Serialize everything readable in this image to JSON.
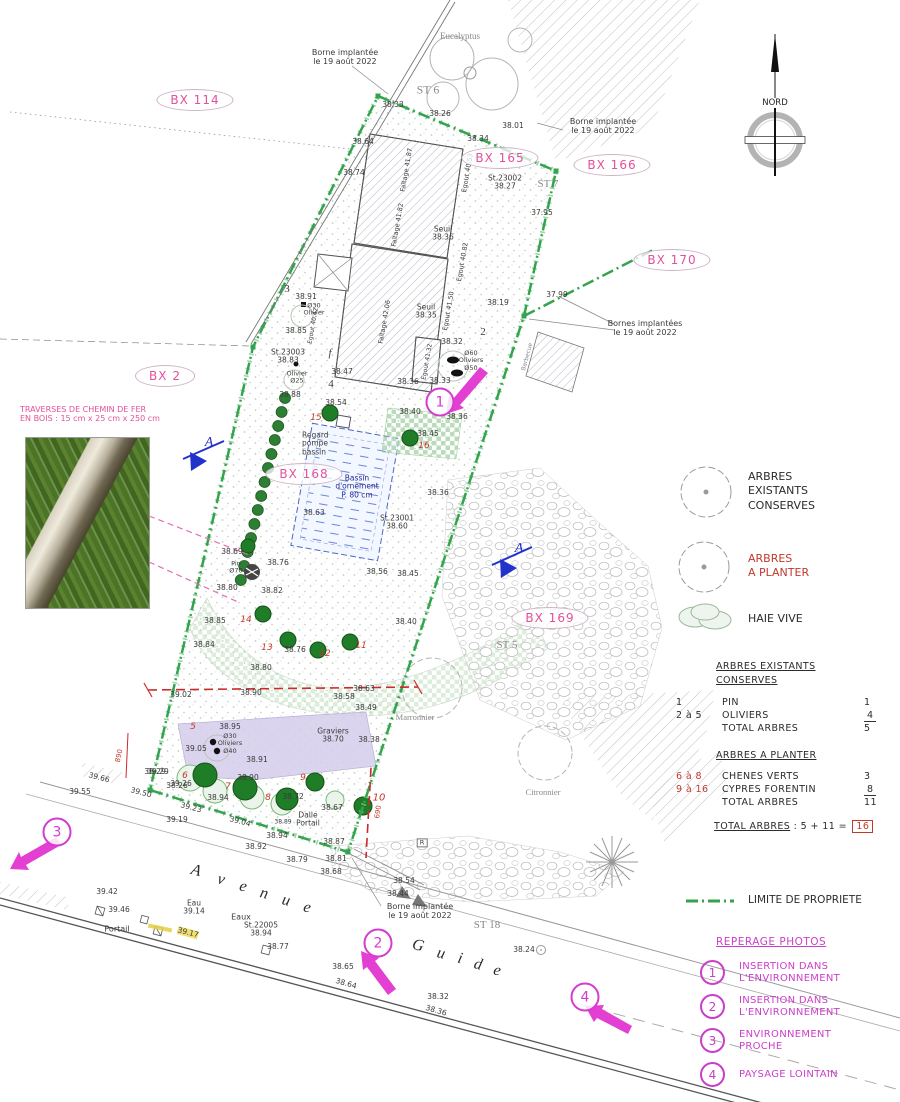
{
  "compass": {
    "label": "NORD"
  },
  "legend": {
    "existing": "ARBRES\nEXISTANTS\nCONSERVES",
    "plant": "ARBRES\nA PLANTER",
    "hedge": "HAIE VIVE",
    "boundary": "LIMITE DE PROPRIETE"
  },
  "tree_table": {
    "section1": {
      "title": "ARBRES EXISTANTS\nCONSERVES",
      "rows": [
        [
          "1",
          "PIN",
          "1",
          ""
        ],
        [
          "2 à 5",
          "OLIVIERS",
          "4",
          "u"
        ],
        [
          "",
          "TOTAL ARBRES",
          "5",
          ""
        ]
      ]
    },
    "section2": {
      "title": "ARBRES A PLANTER",
      "rows": [
        [
          "6 à 8",
          "CHENES VERTS",
          "3",
          "r"
        ],
        [
          "9 à 16",
          "CYPRES FORENTIN",
          "8",
          "ru"
        ],
        [
          "",
          "TOTAL ARBRES",
          "11",
          ""
        ]
      ]
    },
    "total": {
      "label": "TOTAL ARBRES",
      "calc": ":  5 + 11 =",
      "value": "16"
    }
  },
  "photo_legend": {
    "title": "REPERAGE PHOTOS",
    "items": [
      {
        "n": "1",
        "label": "INSERTION DANS\nL'ENVIRONNEMENT"
      },
      {
        "n": "2",
        "label": "INSERTION DANS\nL'ENVIRONNEMENT"
      },
      {
        "n": "3",
        "label": "ENVIRONNEMENT\nPROCHE"
      },
      {
        "n": "4",
        "label": "PAYSAGE LOINTAIN"
      }
    ]
  },
  "street": {
    "letters": [
      {
        "c": "A",
        "x": 196,
        "y": 871
      },
      {
        "c": "v",
        "x": 221,
        "y": 880
      },
      {
        "c": "e",
        "x": 243,
        "y": 887
      },
      {
        "c": "n",
        "x": 264,
        "y": 894
      },
      {
        "c": "u",
        "x": 286,
        "y": 901
      },
      {
        "c": "e",
        "x": 307,
        "y": 908
      },
      {
        "c": "G",
        "x": 418,
        "y": 946
      },
      {
        "c": "u",
        "x": 441,
        "y": 954
      },
      {
        "c": "i",
        "x": 460,
        "y": 959
      },
      {
        "c": "d",
        "x": 478,
        "y": 965
      },
      {
        "c": "e",
        "x": 497,
        "y": 971
      }
    ]
  },
  "plan": {
    "bx_labels": [
      {
        "t": "BX 114",
        "x": 195,
        "y": 100
      },
      {
        "t": "BX 165",
        "x": 500,
        "y": 158
      },
      {
        "t": "BX 166",
        "x": 612,
        "y": 165
      },
      {
        "t": "BX 170",
        "x": 672,
        "y": 260
      },
      {
        "t": "BX 2",
        "x": 165,
        "y": 376
      },
      {
        "t": "BX 168",
        "x": 304,
        "y": 474
      },
      {
        "t": "BX 169",
        "x": 550,
        "y": 618
      }
    ],
    "photo_markers": [
      {
        "n": "1",
        "x": 440,
        "y": 402
      },
      {
        "n": "2",
        "x": 378,
        "y": 943
      },
      {
        "n": "3",
        "x": 57,
        "y": 832
      },
      {
        "n": "4",
        "x": 585,
        "y": 997
      }
    ],
    "labels": [
      {
        "t": "Borne implantée\nle 19 août 2022",
        "x": 345,
        "y": 58,
        "s": 8
      },
      {
        "t": "Eucalyptus",
        "x": 460,
        "y": 36,
        "f": "serif",
        "c": "gray",
        "s": 9
      },
      {
        "t": "ST 6",
        "x": 428,
        "y": 90,
        "f": "serif",
        "c": "gray",
        "s": 12
      },
      {
        "t": "38.33",
        "x": 393,
        "y": 105
      },
      {
        "t": "38.26",
        "x": 440,
        "y": 114
      },
      {
        "t": "38.01",
        "x": 513,
        "y": 126
      },
      {
        "t": "38.34",
        "x": 478,
        "y": 139
      },
      {
        "t": "38.64",
        "x": 363,
        "y": 142
      },
      {
        "t": "Borne implantée\nle 19 août 2022",
        "x": 603,
        "y": 127,
        "s": 8
      },
      {
        "t": "St.23002\n38.27",
        "x": 505,
        "y": 183
      },
      {
        "t": "ST 7",
        "x": 548,
        "y": 184,
        "f": "serif",
        "c": "gray",
        "s": 11
      },
      {
        "t": "37.95",
        "x": 542,
        "y": 213
      },
      {
        "t": "37.99",
        "x": 557,
        "y": 295
      },
      {
        "t": "Bornes implantées\nle 19 août 2022",
        "x": 645,
        "y": 329,
        "s": 8
      },
      {
        "t": "38.74",
        "x": 354,
        "y": 173
      },
      {
        "t": "Faîtage 41.87",
        "x": 407,
        "y": 170,
        "r": -80,
        "s": 6.5
      },
      {
        "t": "Egout 40.53",
        "x": 468,
        "y": 173,
        "r": -80,
        "s": 6.5
      },
      {
        "t": "Seuil\n38.36",
        "x": 443,
        "y": 234
      },
      {
        "t": "Faîtage 41.82",
        "x": 398,
        "y": 225,
        "r": -80,
        "s": 6.5
      },
      {
        "t": "Egout 40.82",
        "x": 463,
        "y": 262,
        "r": -80,
        "s": 6.5
      },
      {
        "t": "Seuil\n38.35",
        "x": 426,
        "y": 312
      },
      {
        "t": "Faîtage 42.06",
        "x": 385,
        "y": 322,
        "r": -80,
        "s": 6.5
      },
      {
        "t": "Egout 41.50",
        "x": 449,
        "y": 311,
        "r": -80,
        "s": 6.5
      },
      {
        "t": "Egout 40.42",
        "x": 314,
        "y": 326,
        "r": -80,
        "s": 6
      },
      {
        "t": "Egout 41.32",
        "x": 428,
        "y": 362,
        "r": -80,
        "s": 6
      },
      {
        "t": "38.19",
        "x": 498,
        "y": 303
      },
      {
        "t": "2",
        "x": 483,
        "y": 332,
        "f": "serif",
        "s": 11
      },
      {
        "t": "3",
        "x": 287,
        "y": 289,
        "f": "serif",
        "s": 11
      },
      {
        "t": "4",
        "x": 331,
        "y": 384,
        "f": "serif",
        "s": 11
      },
      {
        "t": "f",
        "x": 330,
        "y": 353,
        "f": "serif",
        "i": 1,
        "s": 11
      },
      {
        "t": "38.91",
        "x": 306,
        "y": 297
      },
      {
        "t": "Ø30\nOlivier",
        "x": 314,
        "y": 310,
        "s": 6.5
      },
      {
        "t": "38.85",
        "x": 296,
        "y": 331
      },
      {
        "t": "St.23003\n38.83",
        "x": 288,
        "y": 357
      },
      {
        "t": "Olivier\nØ25",
        "x": 297,
        "y": 378,
        "s": 6.5
      },
      {
        "t": "38.88",
        "x": 290,
        "y": 395
      },
      {
        "t": "38.47",
        "x": 342,
        "y": 372
      },
      {
        "t": "38.36",
        "x": 408,
        "y": 382
      },
      {
        "t": "38.33",
        "x": 440,
        "y": 381
      },
      {
        "t": "Ø60\nOliviers\nØ50",
        "x": 471,
        "y": 361,
        "s": 6.5
      },
      {
        "t": "38.32",
        "x": 452,
        "y": 342
      },
      {
        "t": "38.40",
        "x": 410,
        "y": 412
      },
      {
        "t": "38.36",
        "x": 457,
        "y": 417
      },
      {
        "t": "38.45",
        "x": 428,
        "y": 434
      },
      {
        "t": "38.54",
        "x": 336,
        "y": 403
      },
      {
        "t": "15",
        "x": 316,
        "y": 418,
        "c": "red",
        "i": 1,
        "s": 9
      },
      {
        "t": "16",
        "x": 424,
        "y": 446,
        "c": "red",
        "i": 1,
        "s": 9
      },
      {
        "t": "Regard\npompe\nbassin",
        "x": 302,
        "y": 444,
        "al": "l",
        "s": 7.5
      },
      {
        "t": "Bassin\nd'ornement\nP. 80 cm",
        "x": 357,
        "y": 487,
        "c": "navy",
        "s": 7.5
      },
      {
        "t": "38.63",
        "x": 314,
        "y": 513
      },
      {
        "t": "St.23001\n38.60",
        "x": 397,
        "y": 523
      },
      {
        "t": "38.36",
        "x": 438,
        "y": 493
      },
      {
        "t": "Barbecue",
        "x": 528,
        "y": 357,
        "r": -75,
        "s": 6,
        "c": "gray"
      },
      {
        "t": "38.69",
        "x": 232,
        "y": 552
      },
      {
        "t": "Pin\nØ70",
        "x": 236,
        "y": 568,
        "s": 6.5
      },
      {
        "t": "38.76",
        "x": 278,
        "y": 563
      },
      {
        "t": "38.56",
        "x": 377,
        "y": 572
      },
      {
        "t": "38.45",
        "x": 408,
        "y": 574
      },
      {
        "t": "38.80",
        "x": 227,
        "y": 588
      },
      {
        "t": "38.82",
        "x": 272,
        "y": 591
      },
      {
        "t": "38.85",
        "x": 215,
        "y": 621
      },
      {
        "t": "38.84",
        "x": 204,
        "y": 645
      },
      {
        "t": "38.40",
        "x": 406,
        "y": 622
      },
      {
        "t": "14",
        "x": 246,
        "y": 620,
        "c": "red",
        "i": 1,
        "s": 9
      },
      {
        "t": "13",
        "x": 267,
        "y": 648,
        "c": "red",
        "i": 1,
        "s": 9
      },
      {
        "t": "12",
        "x": 325,
        "y": 654,
        "c": "red",
        "i": 1,
        "s": 9
      },
      {
        "t": "11",
        "x": 361,
        "y": 646,
        "c": "red",
        "i": 1,
        "s": 9
      },
      {
        "t": "38.76",
        "x": 295,
        "y": 650
      },
      {
        "t": "38.80",
        "x": 261,
        "y": 668
      },
      {
        "t": "38.63",
        "x": 364,
        "y": 689
      },
      {
        "t": "38.58",
        "x": 344,
        "y": 697
      },
      {
        "t": "38.90",
        "x": 251,
        "y": 693
      },
      {
        "t": "39.02",
        "x": 181,
        "y": 695
      },
      {
        "t": "38.49",
        "x": 366,
        "y": 708
      },
      {
        "t": "Graviers\n38.70",
        "x": 333,
        "y": 736,
        "s": 7.5
      },
      {
        "t": "38.38",
        "x": 369,
        "y": 740
      },
      {
        "t": "38.91",
        "x": 257,
        "y": 760
      },
      {
        "t": "Ø30\nOliviers\nØ40",
        "x": 230,
        "y": 744,
        "s": 6.5
      },
      {
        "t": "39.05",
        "x": 196,
        "y": 749
      },
      {
        "t": "38.95",
        "x": 230,
        "y": 727
      },
      {
        "t": "5",
        "x": 193,
        "y": 727,
        "c": "red",
        "i": 1,
        "s": 9
      },
      {
        "t": "6",
        "x": 185,
        "y": 776,
        "c": "red",
        "i": 1,
        "s": 9
      },
      {
        "t": "7",
        "x": 228,
        "y": 787,
        "c": "red",
        "i": 1,
        "s": 9
      },
      {
        "t": "8",
        "x": 268,
        "y": 798,
        "c": "red",
        "i": 1,
        "s": 9
      },
      {
        "t": "9",
        "x": 303,
        "y": 778,
        "c": "red",
        "i": 1,
        "s": 9
      },
      {
        "t": "10",
        "x": 379,
        "y": 798,
        "c": "red",
        "i": 1,
        "s": 10
      },
      {
        "t": "38.29",
        "x": 155,
        "y": 772
      },
      {
        "t": "38.26",
        "x": 177,
        "y": 786
      },
      {
        "t": "38.94",
        "x": 218,
        "y": 798
      },
      {
        "t": "38.90",
        "x": 248,
        "y": 778
      },
      {
        "t": "38.72",
        "x": 293,
        "y": 797
      },
      {
        "t": "38.67",
        "x": 332,
        "y": 808
      },
      {
        "t": "Dalle\nPortail",
        "x": 308,
        "y": 820,
        "s": 7.5
      },
      {
        "t": "38.89",
        "x": 283,
        "y": 823,
        "s": 6
      },
      {
        "t": "38.94",
        "x": 277,
        "y": 836
      },
      {
        "t": "38.92",
        "x": 256,
        "y": 847
      },
      {
        "t": "38.87",
        "x": 334,
        "y": 842
      },
      {
        "t": "38.79",
        "x": 297,
        "y": 860
      },
      {
        "t": "38.81",
        "x": 336,
        "y": 859
      },
      {
        "t": "38.68",
        "x": 331,
        "y": 872
      },
      {
        "t": "38.54",
        "x": 404,
        "y": 881
      },
      {
        "t": "38.44",
        "x": 398,
        "y": 894
      },
      {
        "t": "R",
        "x": 422,
        "y": 843,
        "s": 6.5,
        "bx": 1
      },
      {
        "t": "Borne implantée\nle 19 août 2022",
        "x": 420,
        "y": 912,
        "s": 8
      },
      {
        "t": "ST 18",
        "x": 487,
        "y": 925,
        "f": "serif",
        "c": "gray",
        "s": 11
      },
      {
        "t": "38.24",
        "x": 524,
        "y": 950
      },
      {
        "t": "890",
        "x": 120,
        "y": 756,
        "c": "red",
        "r": -78,
        "s": 7
      },
      {
        "t": "690",
        "x": 379,
        "y": 812,
        "c": "red",
        "r": -82,
        "s": 7
      },
      {
        "t": "39.55",
        "x": 80,
        "y": 792
      },
      {
        "t": "39.66",
        "x": 99,
        "y": 778,
        "r": 15
      },
      {
        "t": "39.50",
        "x": 141,
        "y": 793,
        "r": 15
      },
      {
        "t": "39.29",
        "x": 158,
        "y": 772
      },
      {
        "t": "39.26",
        "x": 181,
        "y": 784
      },
      {
        "t": "39.23",
        "x": 191,
        "y": 808,
        "r": 15
      },
      {
        "t": "39.19",
        "x": 177,
        "y": 820
      },
      {
        "t": "39.04",
        "x": 240,
        "y": 822,
        "r": 15
      },
      {
        "t": "39.42",
        "x": 107,
        "y": 892
      },
      {
        "t": "39.46",
        "x": 119,
        "y": 910
      },
      {
        "t": "Portail",
        "x": 117,
        "y": 930,
        "s": 8
      },
      {
        "t": "Eau\n39.14",
        "x": 194,
        "y": 908
      },
      {
        "t": "Eaux",
        "x": 241,
        "y": 918,
        "s": 8
      },
      {
        "t": "St.22005\n38.94",
        "x": 261,
        "y": 930
      },
      {
        "t": "39.17",
        "x": 188,
        "y": 933,
        "r": 15,
        "hl": 1
      },
      {
        "t": "38.77",
        "x": 278,
        "y": 947
      },
      {
        "t": "38.65",
        "x": 343,
        "y": 967
      },
      {
        "t": "38.64",
        "x": 346,
        "y": 984,
        "r": 16
      },
      {
        "t": "38.32",
        "x": 438,
        "y": 997
      },
      {
        "t": "38.36",
        "x": 436,
        "y": 1011,
        "r": 16
      },
      {
        "t": "Marronnier",
        "x": 415,
        "y": 718,
        "f": "serif",
        "c": "gray",
        "s": 8.5
      },
      {
        "t": "Citronnier",
        "x": 543,
        "y": 793,
        "f": "serif",
        "c": "gray",
        "s": 8.5
      },
      {
        "t": "ST 5",
        "x": 507,
        "y": 645,
        "f": "serif",
        "c": "gray",
        "s": 11
      },
      {
        "t": "A",
        "x": 209,
        "y": 443,
        "c": "blue",
        "f": "serif",
        "i": 1,
        "s": 14
      },
      {
        "t": "A",
        "x": 519,
        "y": 549,
        "c": "blue",
        "f": "serif",
        "i": 1,
        "s": 14
      },
      {
        "t": "TRAVERSES DE CHEMIN DE FER\nEN BOIS : 15 cm x 25 cm x 250 cm",
        "x": 20,
        "y": 415,
        "c": "pink",
        "s": 8,
        "al": "l"
      }
    ]
  }
}
